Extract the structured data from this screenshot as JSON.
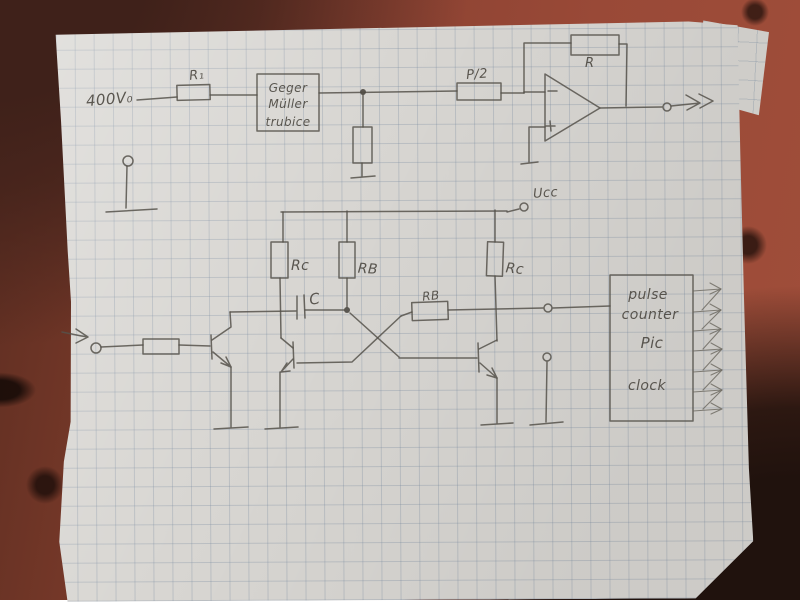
{
  "colors": {
    "table_wood": "#8b4232",
    "table_dark_corner": "#20120d",
    "paper": "#d8d6d2",
    "grid_line": "#76889e",
    "pencil": "#56524b"
  },
  "icons": {
    "input_arrow": "arrow-right",
    "output_arrow": "arrow-right",
    "open_terminal": "open-circle",
    "ground": "ground-bar"
  },
  "schematic": {
    "hv_label": "400V₀",
    "r1_label": "R₁",
    "gm_tube": {
      "line1": "Geger",
      "line2": "Müller",
      "line3": "trubice"
    },
    "p2_label": "P/2",
    "feedback_r_label": "R",
    "supply_label": "Ucc",
    "rc_left_label": "Rc",
    "rb_top_label": "RB",
    "rc_right_label": "Rc",
    "cap_label": "C",
    "rb_mid_label": "RB",
    "counter_box": {
      "line1": "pulse",
      "line2": "counter",
      "line3": "Pic",
      "line4": "clock"
    }
  }
}
